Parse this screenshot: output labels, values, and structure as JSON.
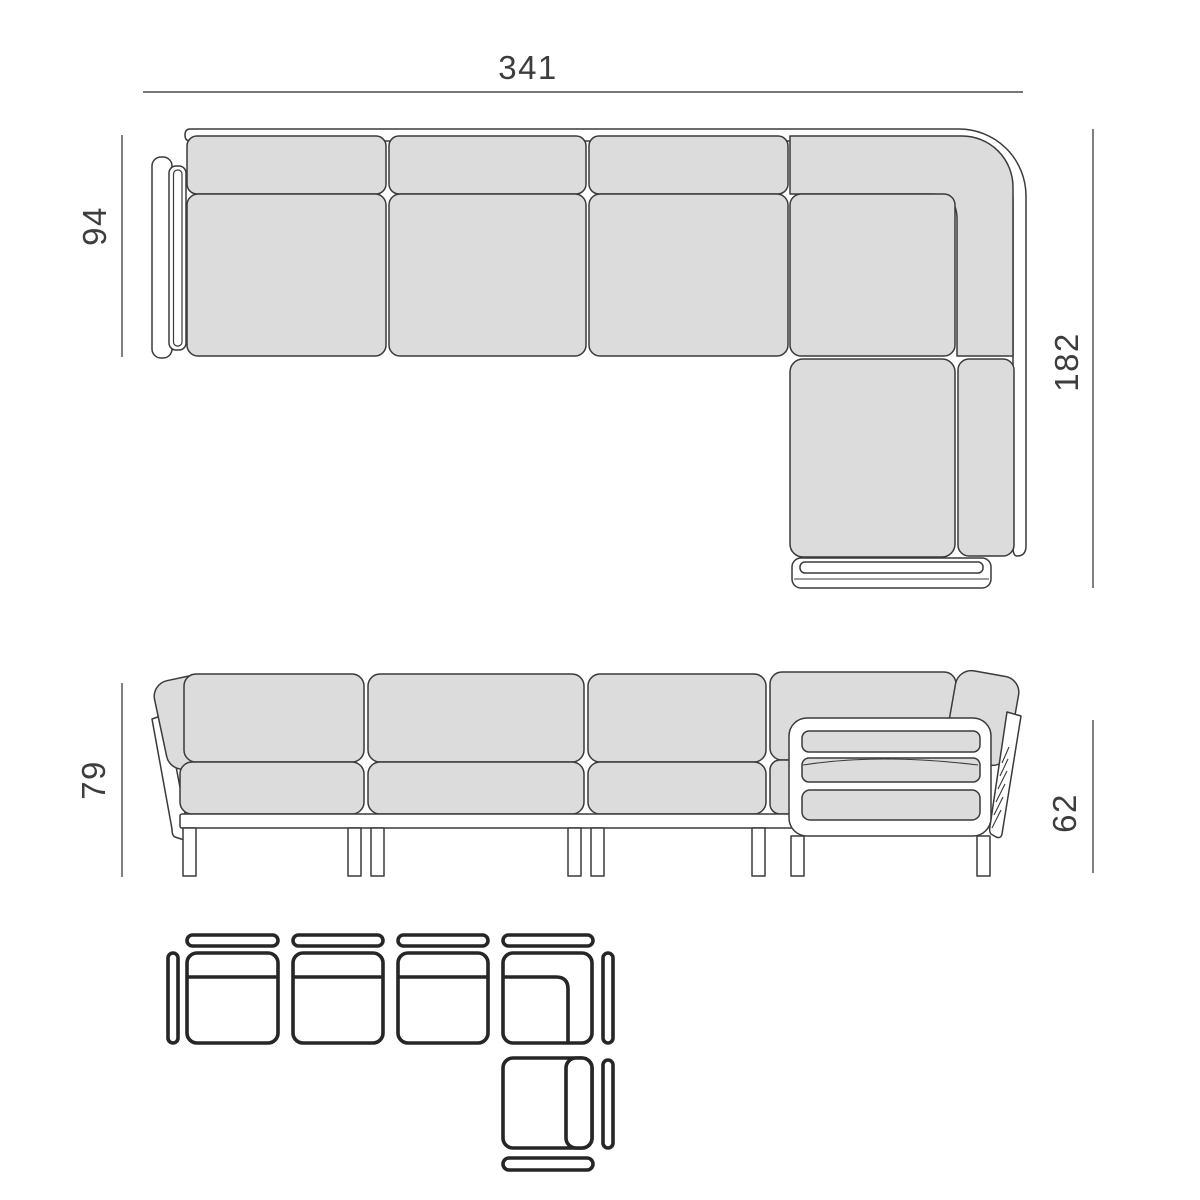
{
  "dimensions": {
    "overall_width": "341",
    "sofa_depth": "94",
    "chaise_depth": "182",
    "back_height": "79",
    "arm_height": "62"
  },
  "colors": {
    "background": "#ffffff",
    "cushion_fill": "#dcdcdc",
    "outline": "#3a3a3a",
    "dim_line": "#4a4a4a",
    "dim_text": "#3d3d3d",
    "schematic_line": "#262626"
  }
}
